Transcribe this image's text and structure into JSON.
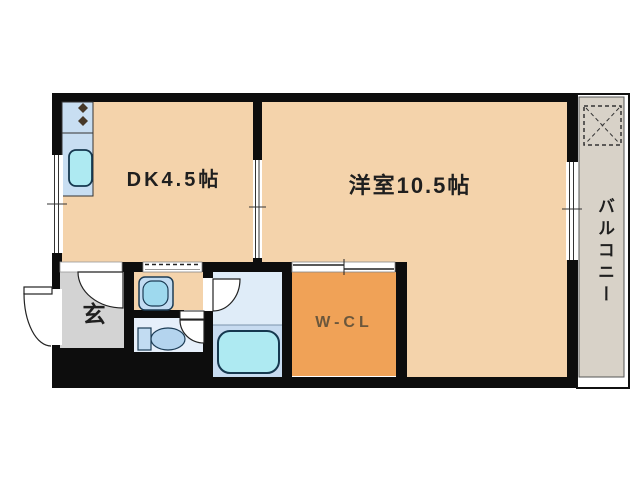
{
  "plan": {
    "type": "apartment-floor-plan",
    "rooms": {
      "dk": {
        "label": "DK4.5帖",
        "area_jo": 4.5,
        "fill": "#f4d3ab"
      },
      "living": {
        "label": "洋室10.5帖",
        "area_jo": 10.5,
        "fill": "#f4d3ab"
      },
      "balcony": {
        "label": "バルコニー",
        "fill": "#d8d2c8"
      },
      "genkan": {
        "label": "玄",
        "fill": "#d3d3d3"
      },
      "wcl": {
        "label": "W-CL",
        "fill": "#f0a257"
      },
      "washroom": {
        "label": "",
        "fill": "#f4d3ab"
      },
      "toilet": {
        "label": "",
        "fill": "#e6effa"
      },
      "bathroom": {
        "label": "",
        "fill_upper": "#dfecf8",
        "fill_lower": "#c7dbf0"
      }
    },
    "fixtures": [
      "kitchen-counter",
      "stove-burners",
      "kitchen-sink",
      "wash-basin",
      "toilet-bowl",
      "bathtub",
      "washer-pan",
      "entrance-door",
      "hall-door",
      "bathroom-door",
      "toilet-door",
      "sliding-door-dk-living",
      "sliding-door-washroom",
      "sliding-door-wcl",
      "window-left",
      "window-right"
    ],
    "colors": {
      "wall": "#0d0d0d",
      "room_tan": "#f4d3ab",
      "wcl_orange": "#f0a257",
      "genkan_gray": "#d3d3d3",
      "balcony_gray": "#d8d2c8",
      "bathroom_upper": "#dfecf8",
      "bathroom_lower": "#c7dbf0",
      "toilet_room": "#e6effa",
      "fixture_blue": "#c2dcf2",
      "water_cyan": "#aeeaf2",
      "kitchen_blue": "#c8def2",
      "burner_brown": "#463828",
      "label_text": "#1f1f1f",
      "wcl_text": "#6b573c"
    }
  }
}
